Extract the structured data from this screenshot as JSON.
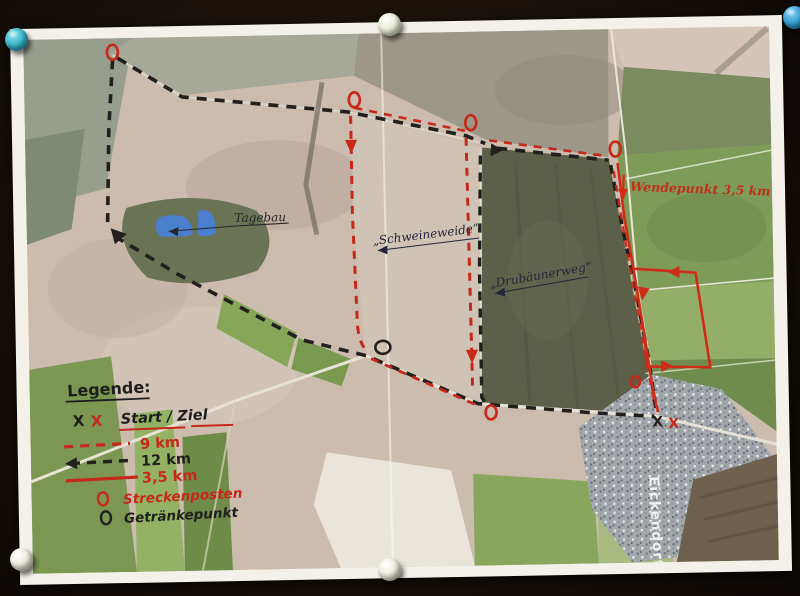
{
  "legend": {
    "title": "Legende:",
    "start_symbol_black": "X",
    "start_symbol_red": "X",
    "start_label": "Start / Ziel",
    "routes": [
      {
        "label": "9 km",
        "color": "#c6281a",
        "style": "dashed"
      },
      {
        "label": "12 km",
        "color": "#22201e",
        "style": "dashed-arrow"
      },
      {
        "label": "3,5 km",
        "color": "#c6281a",
        "style": "solid"
      }
    ],
    "streckenposten": {
      "symbol": "O",
      "label": "Streckenposten",
      "color": "#c6281a"
    },
    "getraenkepunkt": {
      "symbol": "O",
      "label": "Getränkepunkt",
      "color": "#22201e"
    }
  },
  "map_labels": {
    "tagebau": "Tagebau",
    "schweineweide": "„Schweineweide“",
    "drubaeunerweg": "„Drubäunerweg“",
    "wendepunkt": "Wendepunkt 3,5 km",
    "village": "Eickendorf",
    "start_finish_black": "X",
    "start_finish_red": "X"
  },
  "colors": {
    "route_red": "#c6281a",
    "route_black": "#22201e",
    "lake_blue": "#4a7fce",
    "photo_border": "#f3f1ea",
    "board_background": "#170f09"
  },
  "pins": [
    {
      "name": "pin-top-left",
      "color": "#35b3c8"
    },
    {
      "name": "pin-top-center",
      "color": "#e7ecd8"
    },
    {
      "name": "pin-top-right",
      "color": "#2f9ed2"
    },
    {
      "name": "pin-bottom-left",
      "color": "#ebe8da"
    },
    {
      "name": "pin-bottom-center",
      "color": "#ebe8da"
    }
  ]
}
